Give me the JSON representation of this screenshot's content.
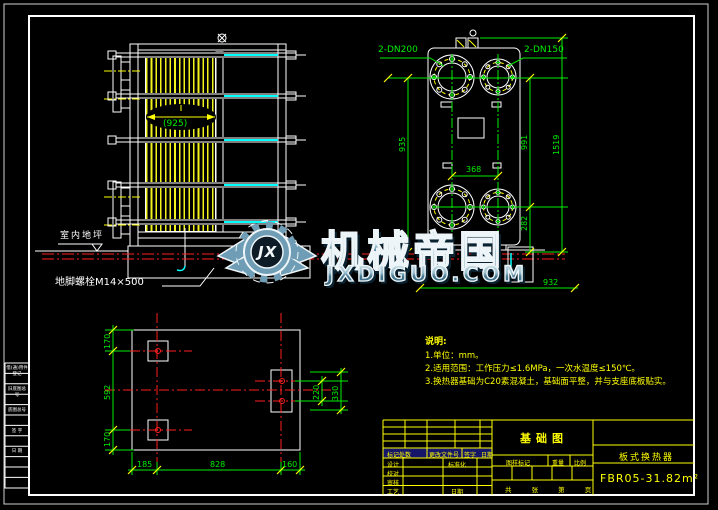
{
  "watermark": {
    "brand": "机械帝国",
    "site": "JXDIGUO.COM",
    "monogram": "JX"
  },
  "front_view": {
    "width_dim": "(925)",
    "floor_label": "室内地坪",
    "anchor_label": "地脚螺栓M14×500"
  },
  "side_view": {
    "nozzle_left": "2-DN200",
    "nozzle_right": "2-DN150",
    "dim_935": "935",
    "dim_991": "991",
    "dim_1519": "1519",
    "dim_282": "282",
    "dim_368": "368",
    "dim_932": "932"
  },
  "plan_view": {
    "dim_left_top": "170",
    "dim_left_mid": "592",
    "dim_left_bottom": "170",
    "dim_bottom_left": "185",
    "dim_bottom_mid": "828",
    "dim_bottom_right": "160",
    "dim_right_inner": "220",
    "dim_right_outer": "330"
  },
  "notes": {
    "heading": "说明:",
    "lines": [
      "1.单位：mm。",
      "2.适用范围：工作压力≤1.6MPa，一次水温度≤150℃。",
      "3.换热器基础为C20素混凝土，基础面平整，并与支座底板贴实。"
    ]
  },
  "title_block": {
    "drawing_title": "基础图",
    "product_name": "板式换热器",
    "model": "FBR05-31.82m²",
    "rev_c1": "标记处数",
    "rev_c2": "更改文件号",
    "rev_c3": "签字",
    "rev_c4": "日期",
    "row1": "设计",
    "row2": "校对",
    "row3": "审核",
    "row4": "工艺",
    "aux1": "标准化",
    "aux2": "日期",
    "mid1": "图样标记",
    "mid2": "重量",
    "mid3": "比例",
    "sheet": "共 张 第 页"
  },
  "margin_strip": {
    "r1": "借(通)用件登记",
    "r2": "旧底图总号",
    "r3": "底图总号",
    "r4": "签 字",
    "r5": "日 期"
  },
  "colors": {
    "background": "#000000",
    "linework": "#ffffff",
    "dimension": "#00ee00",
    "hatch": "#f2f21c",
    "centerline_red": "#ff2020",
    "bolt_cyan": "#00ffff",
    "titleblock": "#ffff00",
    "watermark_blue": "#6e9db5"
  }
}
